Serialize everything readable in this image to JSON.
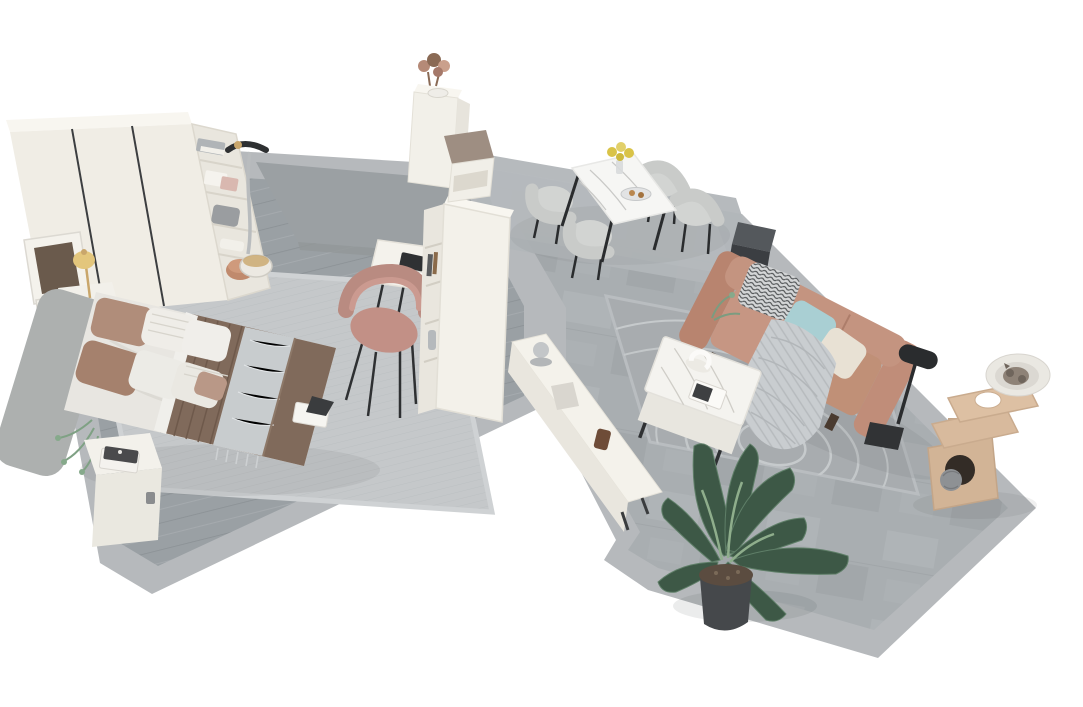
{
  "scene": {
    "kind": "3d-isometric-apartment-render",
    "background_color": "#ffffff",
    "palette": {
      "floor_wood": "#9aa0a4",
      "floor_stone": "#a9aeb1",
      "floor_border": "#b6b9bc",
      "rug_bedroom": "#c5c8ca",
      "rug_dining": "#b2b6b9",
      "rug_living": "#a8acaf",
      "furniture_white": "#f2f0e9",
      "sofa_terracotta": "#bf8a74",
      "pillow_teal": "#a9cfd3",
      "pillow_cream": "#e8e1d4",
      "duvet_brown": "#806a5b",
      "chair_pink": "#c29086",
      "chair_gray": "#c9cbc9",
      "cat_tree_beige": "#d3b496",
      "plant_green": "#3d5846",
      "accent_black": "#2a2c2e",
      "lamp_gold": "#d9b96a"
    },
    "rooms": [
      {
        "name": "bedroom",
        "floor": "gray wood planks with light gray border",
        "objects": [
          {
            "label": "white wardrobe with open shelving unit",
            "color": "#f0ede5"
          },
          {
            "label": "folded clothes, boxes, woven bag, sneakers and copper bowl on shelves",
            "color": "#b5b9bc"
          },
          {
            "label": "garment steamer",
            "color": "#b9bcbe"
          },
          {
            "label": "two framed pictures",
            "color": "#6a5a4c"
          },
          {
            "label": "gold table lamp on nightstand",
            "color": "#d9b96a"
          },
          {
            "label": "gray upholstered headboard",
            "color": "#adb0af"
          },
          {
            "label": "double bed with white sheets, taupe and striped pillows, brown quilted duvet and silver throw runner",
            "color": "#806a5b"
          },
          {
            "label": "white cube nightstand with books",
            "color": "#f3f1eb"
          },
          {
            "label": "open magazine on rug",
            "color": "#f6f5f1"
          },
          {
            "label": "light gray area rug",
            "color": "#c5c8ca"
          },
          {
            "label": "gray textured mat",
            "color": "#9ba0a3"
          },
          {
            "label": "white desk with laptop, open book and bottle",
            "color": "#f4f2ec"
          },
          {
            "label": "pink upholstered desk chair",
            "color": "#c29086"
          },
          {
            "label": "tall white bookshelf room divider",
            "color": "#f3f1ea"
          },
          {
            "label": "small green plant by headboard",
            "color": "#7fa184"
          }
        ]
      },
      {
        "name": "entryway",
        "floor": "gray stone tile",
        "objects": [
          {
            "label": "white entry cabinet with dried flower arrangement",
            "color": "#f2f0e9"
          },
          {
            "label": "shoe bench with taupe cushion",
            "color": "#9e8e82"
          }
        ]
      },
      {
        "name": "living-dining",
        "floor": "gray stone tile with light gray border",
        "objects": [
          {
            "label": "marble dining table with black legs",
            "color": "#f6f6f4"
          },
          {
            "label": "four gray tub dining chairs",
            "color": "#c9cbc9"
          },
          {
            "label": "vase with yellow flowers",
            "color": "#d9c348"
          },
          {
            "label": "serving plate",
            "color": "#e2e3e4"
          },
          {
            "label": "dark gray side cube behind sofa",
            "color": "#3b3e42"
          },
          {
            "label": "terracotta leather sofa",
            "color": "#bf8a74"
          },
          {
            "label": "patterned, teal and cream sofa pillows",
            "color": "#a9cfd3"
          },
          {
            "label": "gray knit throw blanket",
            "color": "#c9cdd0"
          },
          {
            "label": "black floor lamp",
            "color": "#2a2c2e"
          },
          {
            "label": "white marble coffee table with ring sculpture and magazine",
            "color": "#f4f3ef"
          },
          {
            "label": "long white TV console with decor",
            "color": "#f4f2eb"
          },
          {
            "label": "gray area rug with white swirl pattern",
            "color": "#a8acaf"
          },
          {
            "label": "large potted banana-leaf plant",
            "color": "#3d5846"
          },
          {
            "label": "beige cat tree with sleeping cat",
            "color": "#d3b496"
          }
        ]
      }
    ]
  }
}
